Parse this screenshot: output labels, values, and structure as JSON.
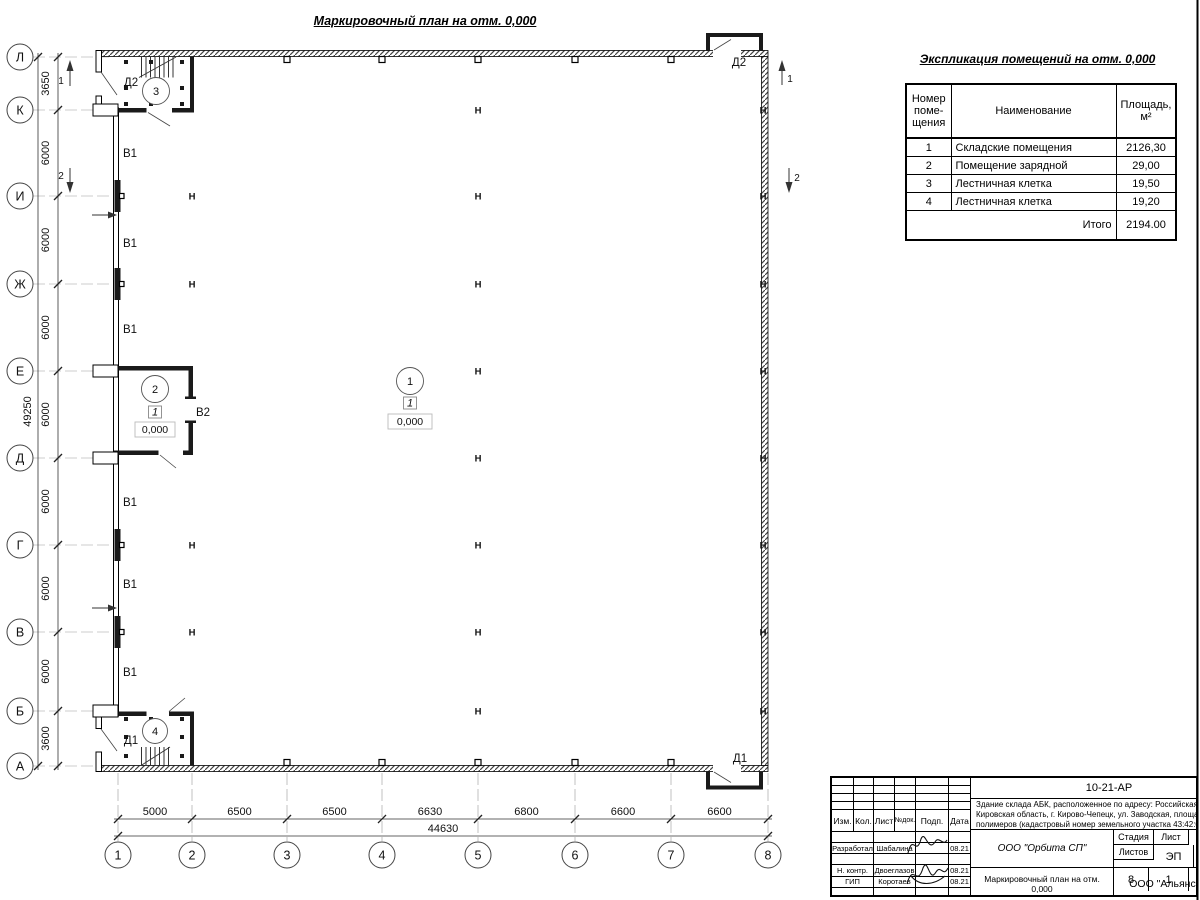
{
  "titles": {
    "main": "Маркировочный план на отм. 0,000",
    "expl": "Экспликация помещений на отм. 0,000"
  },
  "axes": {
    "left": [
      "Л",
      "К",
      "И",
      "Ж",
      "Е",
      "Д",
      "Г",
      "В",
      "Б",
      "А"
    ],
    "bottom": [
      "1",
      "2",
      "3",
      "4",
      "5",
      "6",
      "7",
      "8"
    ]
  },
  "dims": {
    "left": [
      "3650",
      "6000",
      "6000",
      "6000",
      "6000",
      "6000",
      "6000",
      "6000",
      "3600"
    ],
    "left_total": "49250",
    "bottom": [
      "5000",
      "6500",
      "6500",
      "6630",
      "6800",
      "6600",
      "6600"
    ],
    "bottom_total": "44630"
  },
  "plan": {
    "column_mark": "Н",
    "gate_b1": "В1",
    "gate_b2": "В2",
    "door_d1": "Д1",
    "door_d2": "Д2",
    "level_mark": "0,000",
    "floor_type_mark": "1",
    "room1": "1",
    "room2": "2",
    "room3": "3",
    "room4": "4",
    "section1": "1",
    "section2": "2"
  },
  "expl": {
    "col_num": "Номер\nпоме-\nщения",
    "col_name": "Наименование",
    "col_area": "Площадь,\nм²",
    "rows": [
      {
        "num": "1",
        "name": "Складские помещения",
        "area": "2126,30"
      },
      {
        "num": "2",
        "name": "Помещение зарядной",
        "area": "29,00"
      },
      {
        "num": "3",
        "name": "Лестничная клетка",
        "area": "19,50"
      },
      {
        "num": "4",
        "name": "Лестничная клетка",
        "area": "19,20"
      }
    ],
    "total_label": "Итого",
    "total_value": "2194.00"
  },
  "stamp": {
    "doc_number": "10-21-АР",
    "address_line1": "Здание склада АБК, расположенное по адресу: Российская Феде",
    "address_line2": "Кировская область, г. Кирово-Чепецк, ул. Заводская, площадка з",
    "address_line3": "полимеров (кадастровый номер земельного участка 43:42:0000",
    "h_izm": "Изм.",
    "h_kol": "Кол.",
    "h_list": "Лист",
    "h_ndok": "№док.",
    "h_podp": "Подп.",
    "h_data": "Дата",
    "r1_role": "Разработал",
    "r1_name": "Шабалина",
    "r1_date": "08.21",
    "r2_role": "Н. контр.",
    "r2_name": "Двоеглазов",
    "r2_date": "08.21",
    "r3_role": "ГИП",
    "r3_name": "Коротаев",
    "r3_date": "08.21",
    "org": "ООО \"Орбита СП\"",
    "stage_label": "Стадия",
    "sheet_label": "Лист",
    "sheets_label": "Листов",
    "stage": "ЭП",
    "sheet": "8",
    "sheets": "1",
    "drawing_title_line1": "Маркировочный план на отм.",
    "drawing_title_line2": "0,000",
    "company": "ООО \"Альянс"
  }
}
